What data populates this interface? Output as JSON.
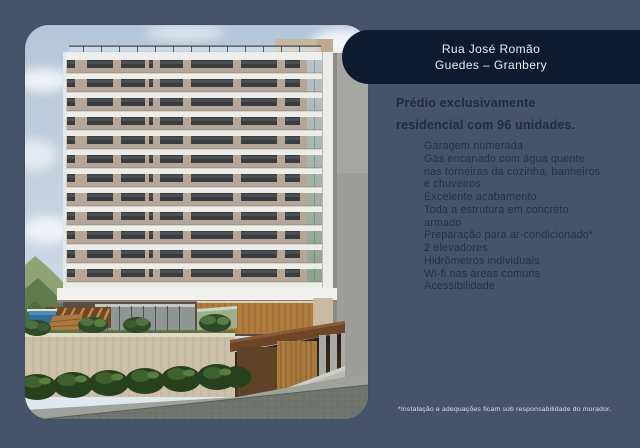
{
  "header": {
    "line1": "Rua José Romão",
    "line2": "Guedes – Granbery"
  },
  "headline": {
    "line1": "Prédio exclusivamente",
    "line2": "residencial com 96 unidades."
  },
  "features": {
    "lines": [
      "Garagem numerada",
      "Gás encanado com água quente",
      "nas torneiras da cozinha, banheiros",
      "e chuveiros",
      "Excelente acabamento",
      "Toda a estrutura em concreto",
      "armado",
      "Preparação para ar-condicionado*",
      "2 elevadores",
      "Hidrômetros individuais",
      "Wi-fi nas áreas comuns",
      "Acessibilidade"
    ]
  },
  "footnote": "*Instalação e adequações ficam sob responsabilidade do morador.",
  "photo": {
    "alt": "Rendering of a residential tower with pool, garden wall and garage entrance"
  },
  "colors": {
    "background": "#46546B",
    "banner": "#0D1B31",
    "banner_text": "#E9EDF4",
    "headline_text": "#1D2B46",
    "list_text": "#20304C",
    "footnote_text": "#D9E0E9",
    "sky": "#BFCFDF",
    "facade_beige": "#B6A698",
    "slab_white": "#EDEEEA",
    "window_dark": "#3B3F40",
    "pool_blue": "#2E6D9B",
    "wood": "#B07C3E"
  }
}
